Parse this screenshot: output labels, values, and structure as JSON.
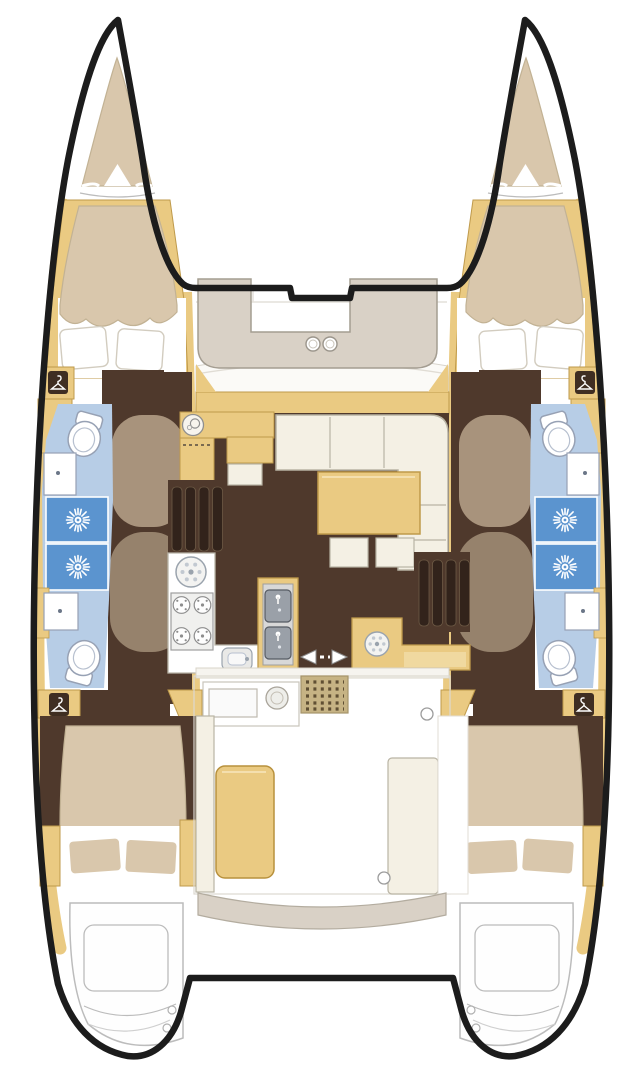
{
  "diagram": {
    "type": "boat-floor-plan",
    "subject": "catamaran-deck-layout",
    "view": "top-down",
    "hulls": 2,
    "cabins": {
      "forward": 2,
      "aft": 2,
      "beds": 4,
      "forepeak_berths": 2
    },
    "bathrooms": {
      "count": 4,
      "toilets": 4,
      "shower_stalls": 4,
      "vanity_basins": 4
    },
    "wardrobes": 4,
    "salon": {
      "sofa_shape": "L-corner",
      "dining_table": 1,
      "ottomans": 2,
      "nav_station_dial": 1
    },
    "galley": {
      "round_sink": 1,
      "stove_burners": 4,
      "island_sink_bowls": 2,
      "small_sink": 1,
      "wet_bar_sink": 1
    },
    "cockpit": {
      "table": 1,
      "doormat": 1,
      "sliding_door_arrows": 2,
      "cup_holders": 2,
      "outdoor_counter_circle": 1
    },
    "stern": {
      "swim_platforms": 2,
      "bench": 1
    },
    "stair_flights_to_hulls": 2
  },
  "colors": {
    "white": "#ffffff",
    "outline": "#1c1c1c",
    "wood": "#eaca82",
    "woodEdge": "#bf9a4b",
    "bed": "#d9c7ac",
    "bedEdge": "#c2b294",
    "sofa": "#f4f0e4",
    "sofaEdge": "#b9b4a4",
    "floor": "#4f392c",
    "slat": "#32231b",
    "stairTaupeA": "#a8937c",
    "stairTaupeB": "#96826c",
    "bathFloor": "#b7cde6",
    "shower": "#5b94cf",
    "deckSeat": "#d9d1c6",
    "deckLine": "#e4e1da",
    "platformLine": "#bcbcbc",
    "fixtureLine": "#97a1b4",
    "mat": "#c6b384",
    "matDot": "#5f4f33",
    "steel": "#9aa0a8",
    "appliance": "#f0f0ee"
  }
}
